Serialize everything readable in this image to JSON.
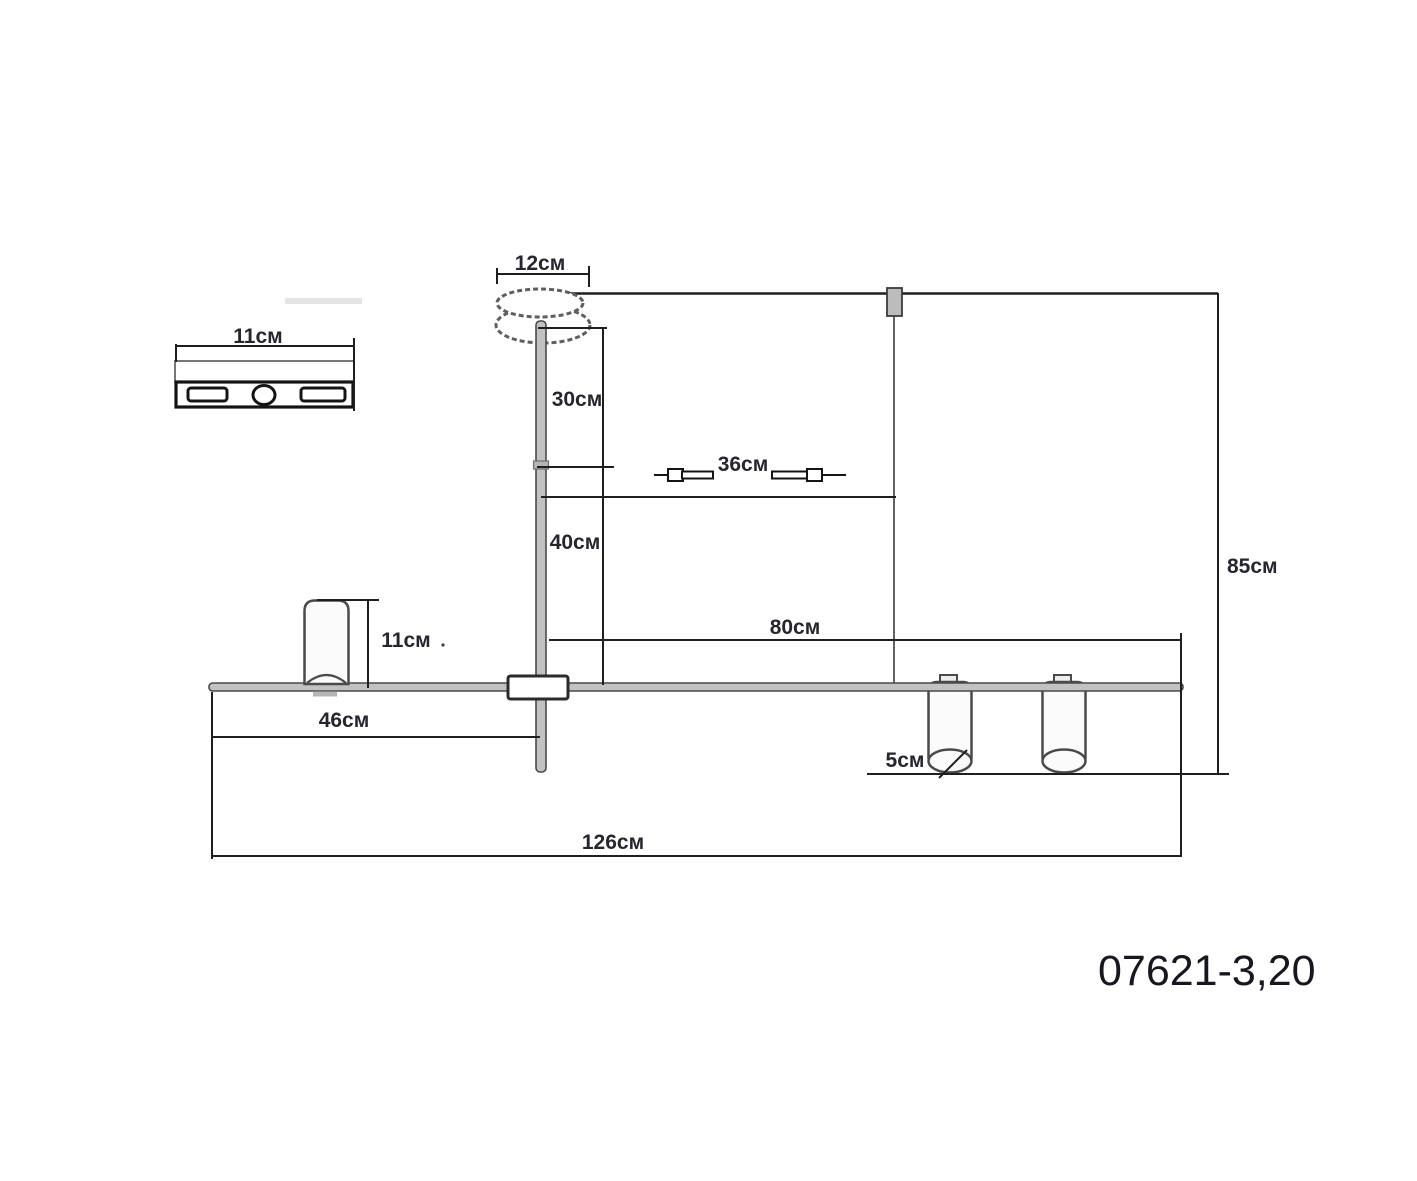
{
  "drawing": {
    "title": "ceiling-lamp-dimension-drawing",
    "model": "07621-3,20",
    "labels": {
      "canopy_width": "12см",
      "bracket_width": "11см",
      "rod_upper": "30см",
      "slide_range": "36см",
      "rod_lower": "40см",
      "shade_height": "11см",
      "left_offset": "46см",
      "right_span": "80см",
      "total_drop": "85см",
      "shade_diameter": "5см",
      "total_length": "126см"
    },
    "colors": {
      "line": "#1f1f1f",
      "outline": "#4a4a4a",
      "metal": "#c2c2c2",
      "text": "#26262e",
      "model": "#17171f",
      "sketch": "#5f5f5f"
    }
  }
}
